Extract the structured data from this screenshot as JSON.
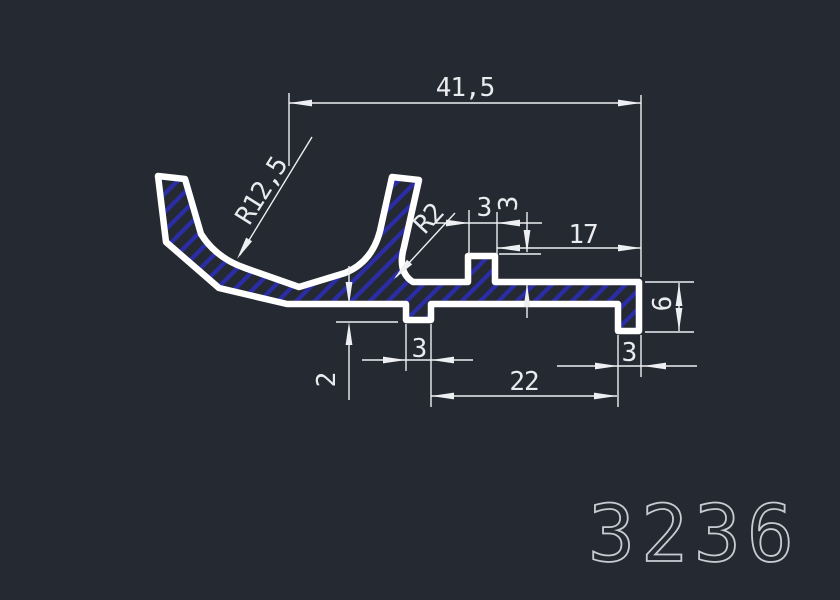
{
  "part_number": "3236",
  "colors": {
    "background": "#252931",
    "profile_outline": "#ffffff",
    "hatch_blue": "#2a2da6",
    "dimension_lines": "#edeff2",
    "part_number_text": "#c7cbd2"
  },
  "dimensions": {
    "total_width": "41,5",
    "radius_large": "R12,5",
    "radius_small": "R2",
    "boss_width": "3",
    "boss_height": "3",
    "boss_to_end": "17",
    "end_height": "6",
    "end_foot_width": "3",
    "foot_span": "22",
    "mid_foot_width": "3",
    "mid_foot_depth": "2"
  }
}
